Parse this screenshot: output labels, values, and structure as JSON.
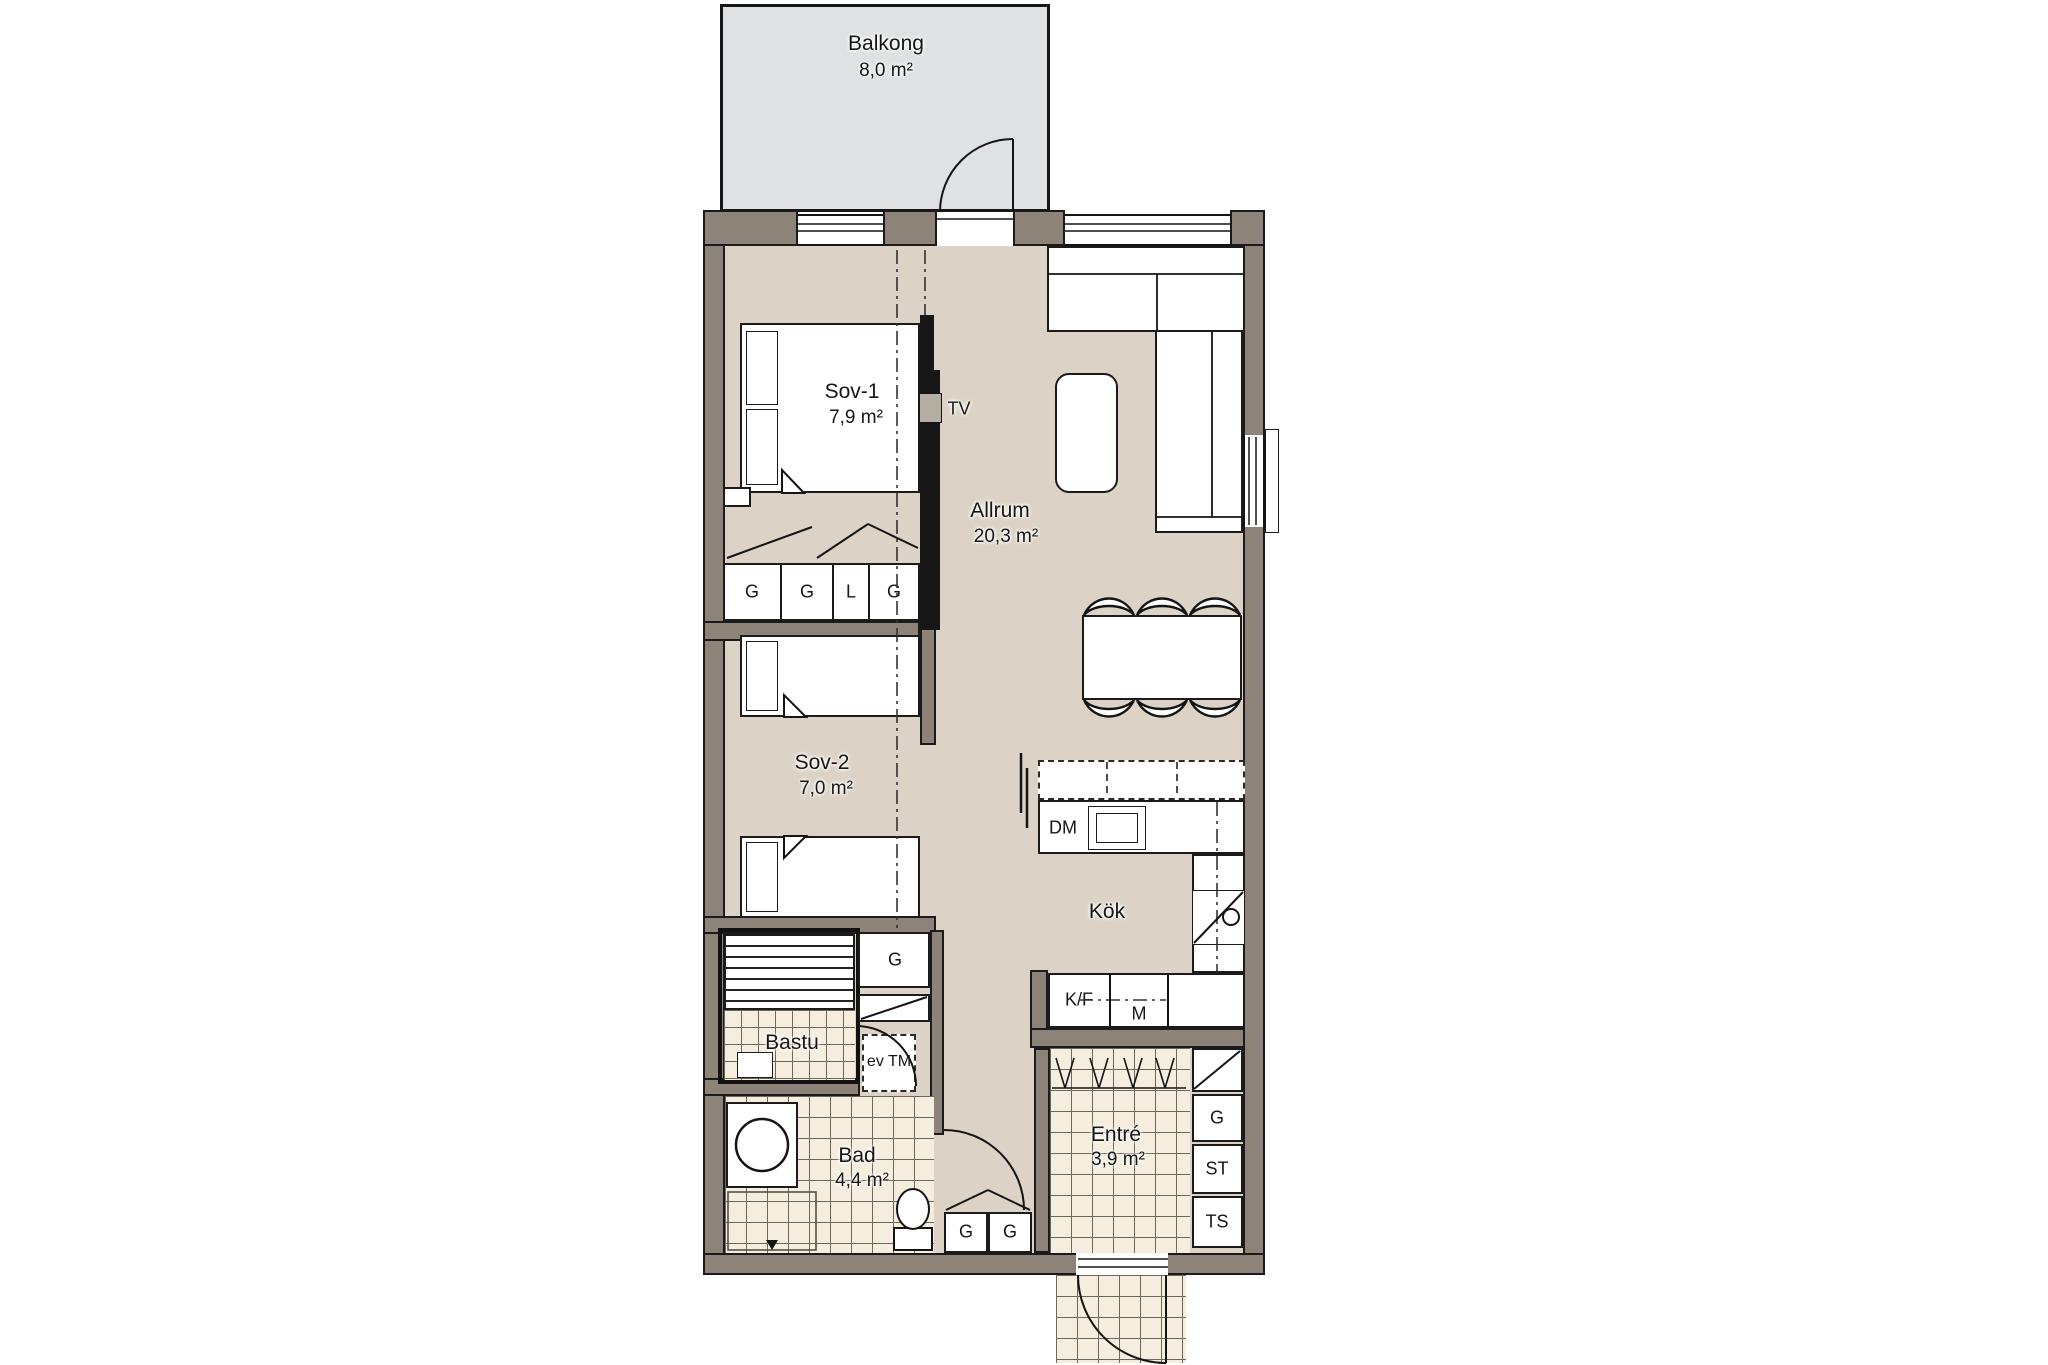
{
  "floorplan": {
    "balcony": {
      "name": "Balkong",
      "area": "8,0 m²"
    },
    "rooms": {
      "sov1": {
        "name": "Sov-1",
        "area": "7,9 m²"
      },
      "allrum": {
        "name": "Allrum",
        "area": "20,3 m²"
      },
      "sov2": {
        "name": "Sov-2",
        "area": "7,0 m²"
      },
      "kok": {
        "name": "Kök"
      },
      "bastu": {
        "name": "Bastu"
      },
      "bad": {
        "name": "Bad",
        "area": "4,4 m²"
      },
      "entre": {
        "name": "Entré",
        "area": "3,9 m²"
      }
    },
    "fixtures": {
      "tv": "TV",
      "dishwasher": "DM",
      "fridge_freezer": "K/F",
      "micro": "M",
      "washer_optional": "ev TM"
    },
    "closets": {
      "sov1_row": [
        "G",
        "G",
        "L",
        "G"
      ],
      "hall_g": "G",
      "bathroom_row": [
        "G",
        "G"
      ],
      "entre_column": [
        "G",
        "ST",
        "TS"
      ]
    },
    "colors": {
      "wall": "#8d8378",
      "floor": "#dcd3c6",
      "balcony": "#dfe1e3",
      "tile": "#f5eede",
      "line": "#1b1b1b"
    }
  }
}
